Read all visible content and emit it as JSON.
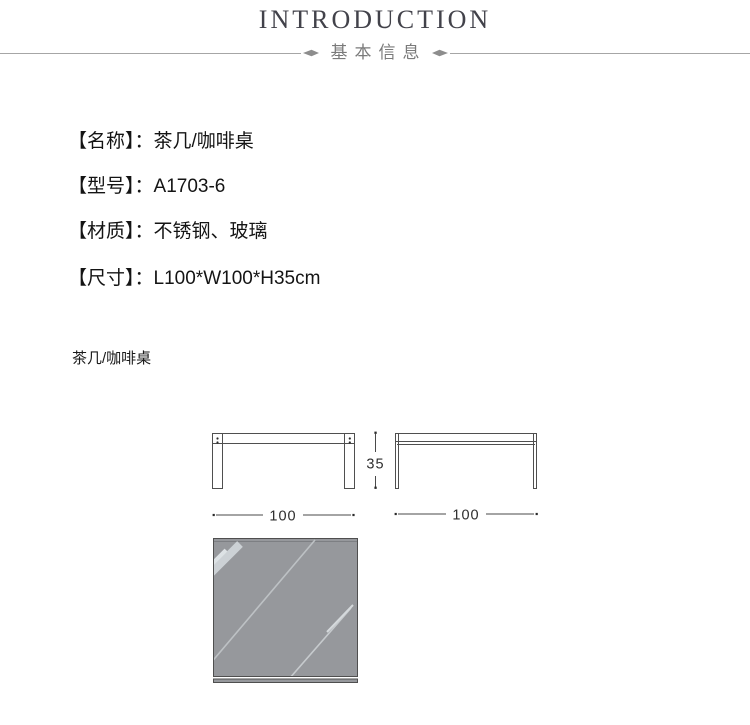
{
  "header": {
    "title": "INTRODUCTION",
    "subtitle": "基本信息"
  },
  "product": {
    "fields": [
      {
        "label": "【名称】",
        "separator": "：",
        "value": "茶几/咖啡桌"
      },
      {
        "label": "【型号】",
        "separator": "：",
        "value": "A1703-6"
      },
      {
        "label": "【材质】",
        "separator": "：",
        "value": "不锈钢、玻璃"
      },
      {
        "label": "【尺寸】",
        "separator": "：",
        "value": "L100*W100*H35cm"
      }
    ]
  },
  "caption": "茶几/咖啡桌",
  "diagram": {
    "front_view_width_label": "100",
    "side_view_width_label": "100",
    "height_label": "35"
  },
  "colors": {
    "title_text": "#42424a",
    "subtitle_text": "#7a7a7a",
    "divider_line": "#a6a6a6",
    "body_text": "#141414",
    "drawing_stroke": "#4f4f4f",
    "glass_fill": "#96989c"
  }
}
